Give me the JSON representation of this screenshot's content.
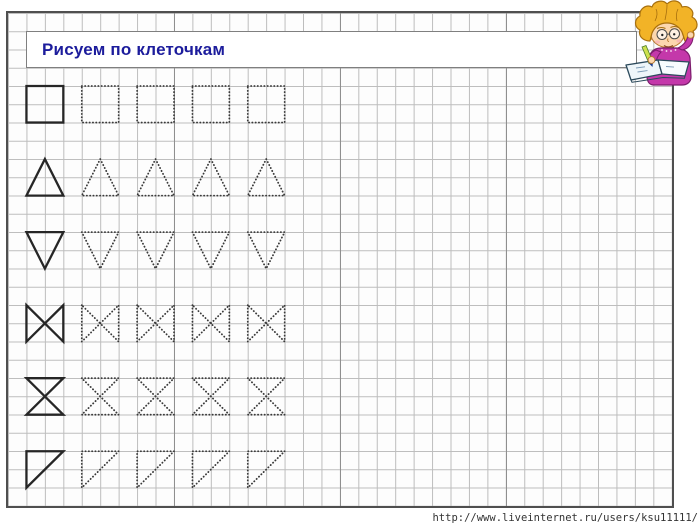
{
  "title_banner": {
    "text": "Рисуем по клеточкам",
    "text_color": "#1c1c9c",
    "border_color": "#7f7f7f"
  },
  "grid": {
    "left": 8,
    "top": 13,
    "width": 664,
    "height": 493,
    "cols": 36,
    "rows": 27,
    "line_color": "#bdbdbd",
    "accent_cols": [
      9,
      18,
      27
    ],
    "accent_line_color": "#8f8f8f",
    "border_color": "#4f4f4f"
  },
  "worksheet": {
    "stroke_solid": "#262626",
    "stroke_dotted": "#3a3a3a",
    "solid_col": 1,
    "dotted_cols": [
      4,
      7,
      10,
      13
    ],
    "shape_cells": 2,
    "rows": [
      {
        "shape": "square",
        "grid_row": 4
      },
      {
        "shape": "triangle-up",
        "grid_row": 8
      },
      {
        "shape": "triangle-down",
        "grid_row": 12
      },
      {
        "shape": "bowtie",
        "grid_row": 16
      },
      {
        "shape": "hourglass",
        "grid_row": 20
      },
      {
        "shape": "right-triangle",
        "grid_row": 24
      }
    ]
  },
  "watermark": {
    "url": "http://www.liveinternet.ru/users/ksu11111/",
    "color": "#333333"
  },
  "illustration": {
    "name": "child-writing",
    "hair": "#f2b327",
    "hair_outline": "#a8700e",
    "skin": "#fcd7ae",
    "skin_outline": "#b5762c",
    "sweater": "#c438aa",
    "sweater_outline": "#7c1d6d",
    "notebook_page": "#eef6fa",
    "notebook_page_right": "#f7fcfe",
    "notebook_outline": "#2c4a5c",
    "pen_body": "#cde14e",
    "pen_body_outline": "#4a7a2a",
    "pen_tip": "#1c3f8f"
  }
}
